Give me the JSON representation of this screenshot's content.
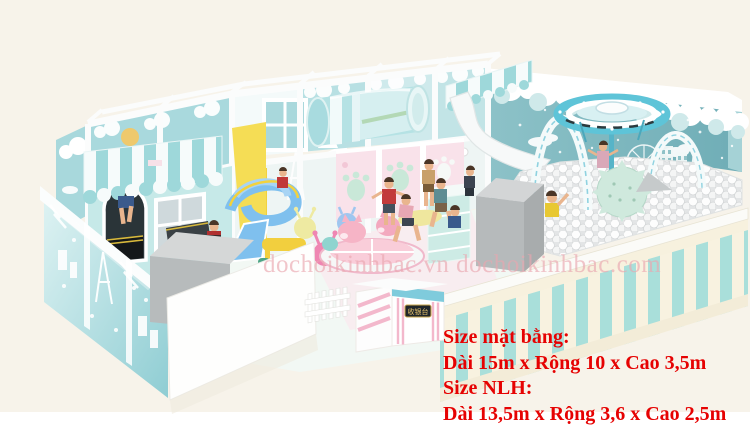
{
  "overlay": {
    "watermark": "dochoikinhbac.vn dochoikinhbac.com",
    "size_info": {
      "line1": "Size mặt bằng:",
      "line2": "Dài 15m x Rộng 10 x Cao 3,5m",
      "line3": "Size NLH:",
      "line4": "Dài 13,5m x Rộng 3,6 x Cao 2,5m"
    }
  },
  "scene": {
    "description": "3D render of pastel candy-theme indoor soft playground with ball pit, slides, crawl tube, carousel and trampolines",
    "desk_sign": "收银台",
    "palette": {
      "background_cream": "#f7f3ea",
      "wall_teal": "#7db8bf",
      "panel_mint": "#bfe4e6",
      "paw_wall_pink": "#f9e2ea",
      "fence_stripe_mint": "#a9dfda",
      "fence_stripe_cream": "#f8f2e0",
      "slide_blue": "#7fc0ee",
      "slide_yellow": "#f2d23e",
      "ball_white": "#ffffff",
      "foam_grey": "#b7bbbc",
      "text_red": "#e60202",
      "watermark_pink": "#eca9af"
    }
  }
}
